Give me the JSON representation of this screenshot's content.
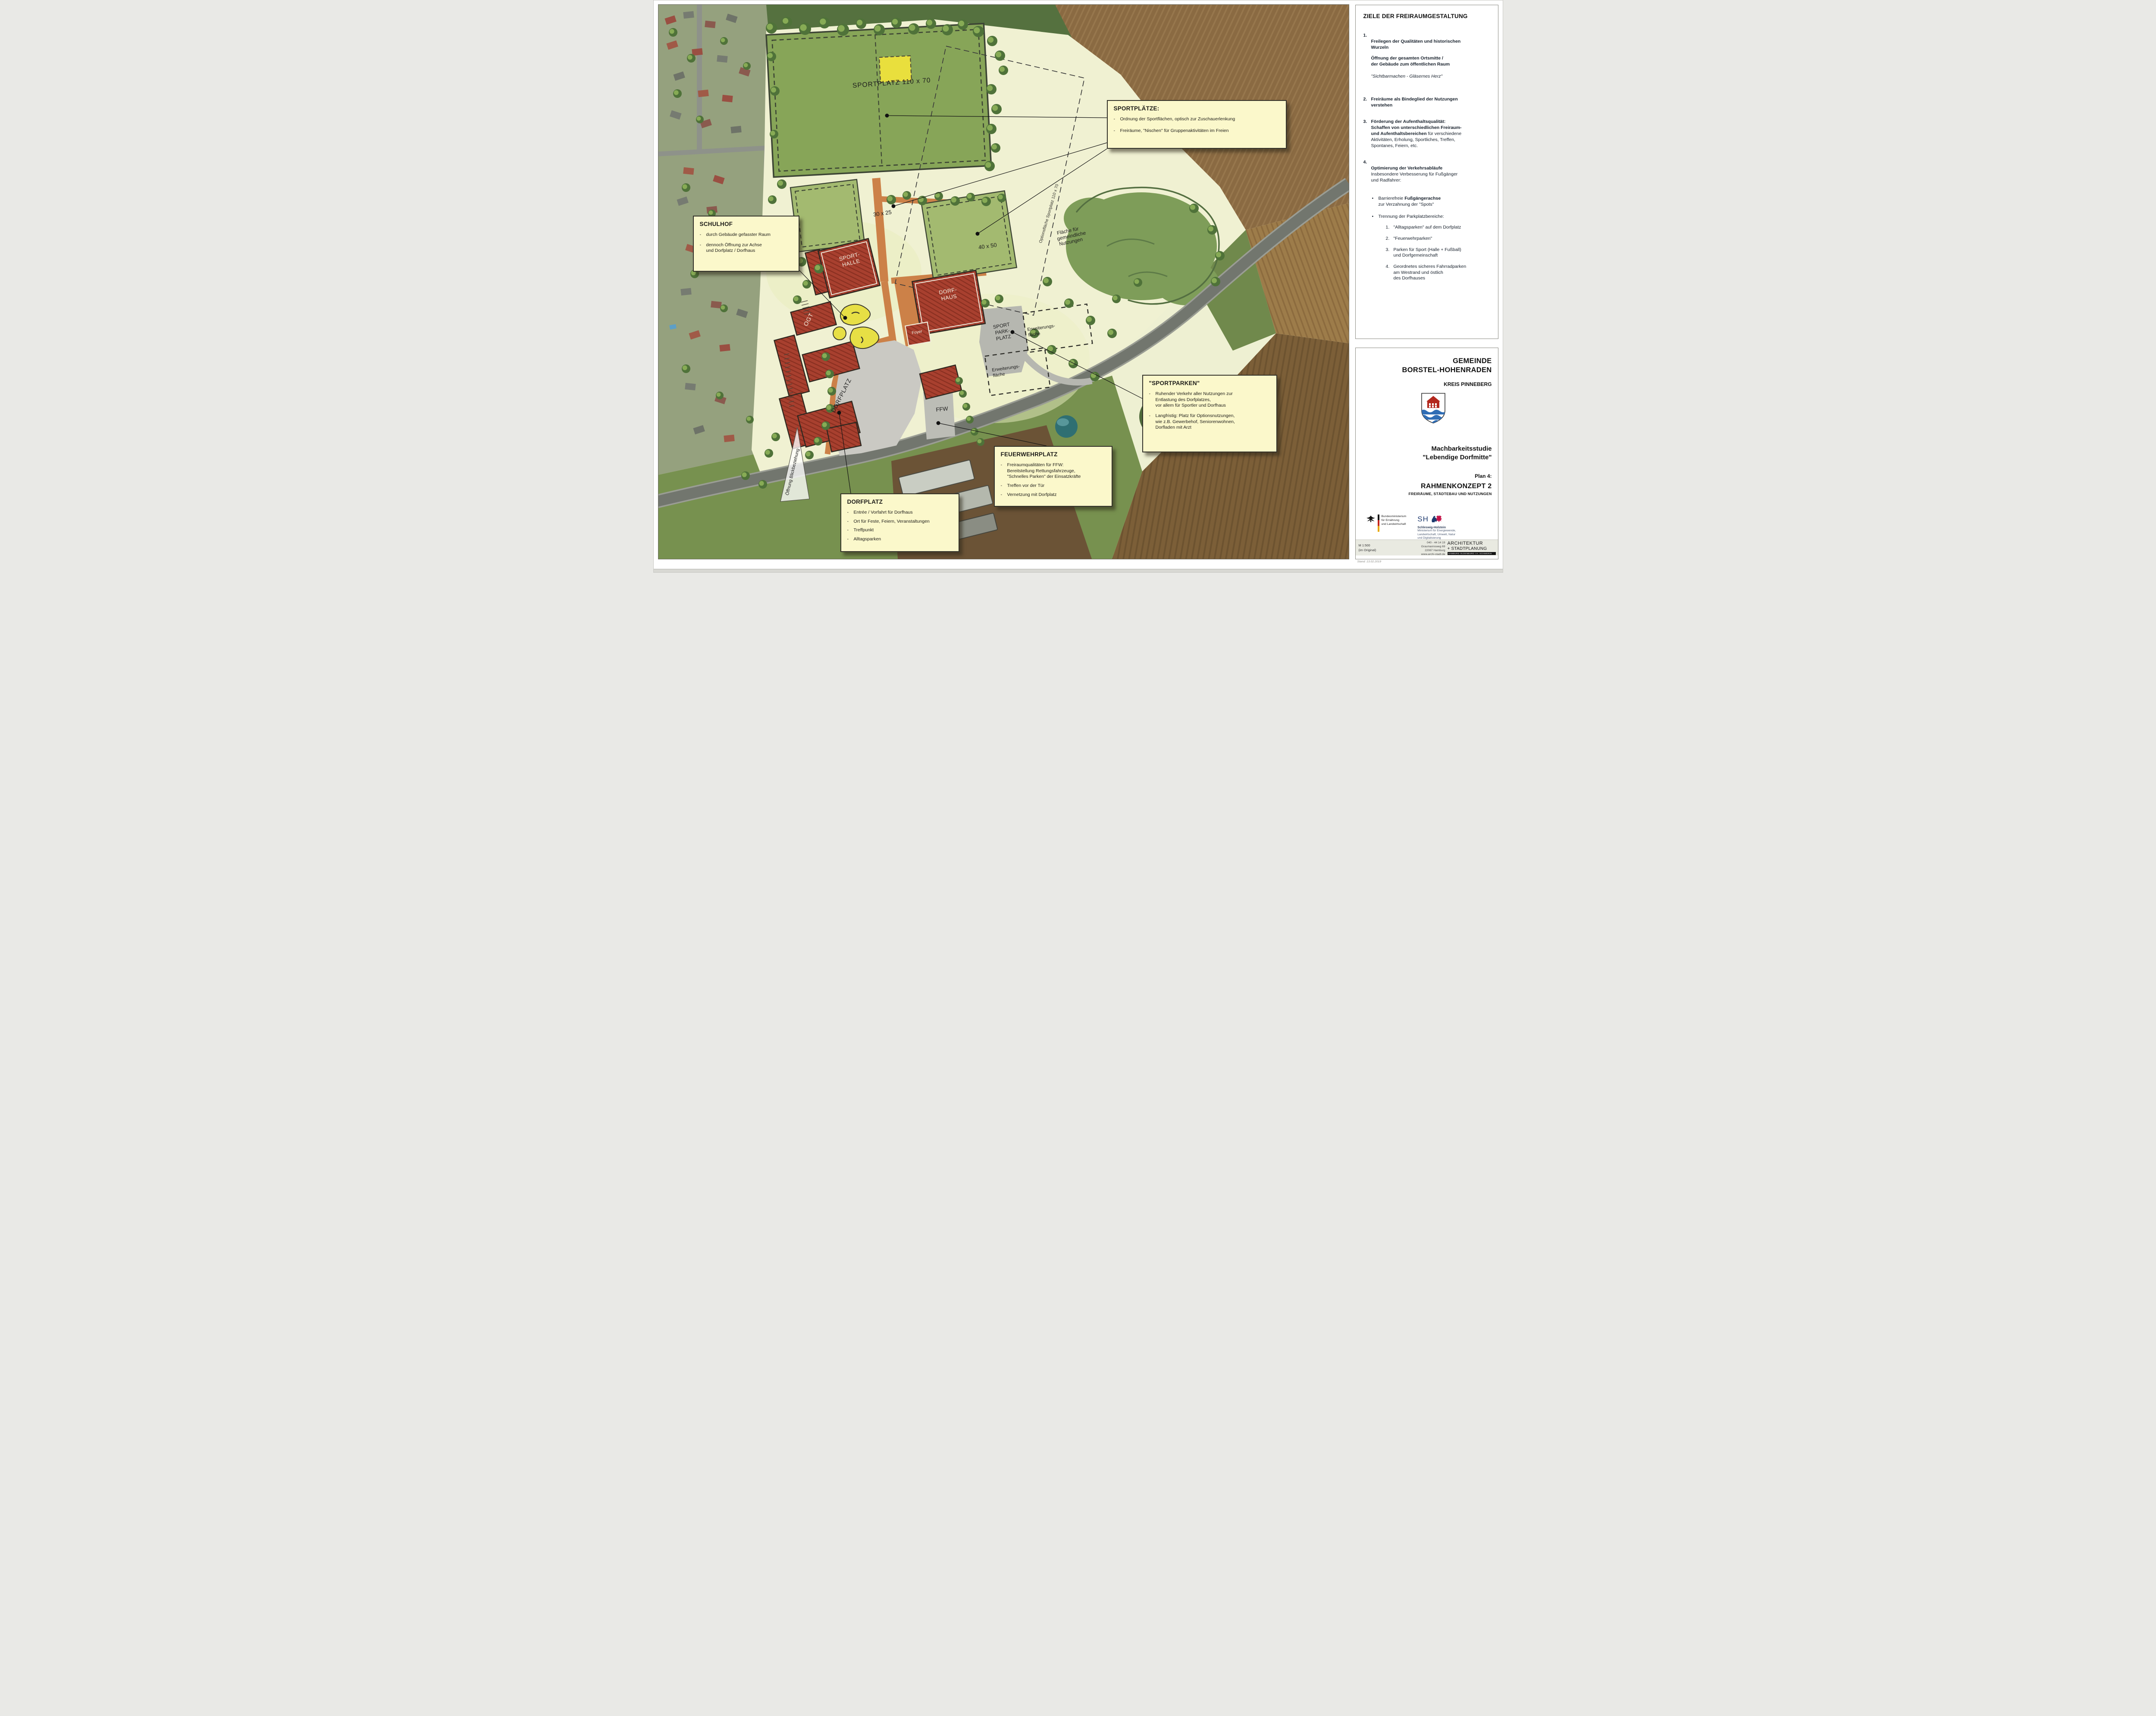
{
  "chars": {
    "dash": "-",
    "bullet": "•"
  },
  "map": {
    "labels": {
      "sportplatz": "SPORTPLATZ 110 x 70",
      "f30": "30 x 25",
      "f40": "40 x 50",
      "sh1": "SPORT-",
      "sh2": "HALLE",
      "dh1": "DORF-",
      "dh2": "HAUS",
      "foyer": "Foyer",
      "ogt": "OGT",
      "ffw": "FFW",
      "dorfplatz": "DORFPLATZ",
      "spp1": "SPORT",
      "spp2": "PARK-",
      "spp3": "PLATZ",
      "erw1": "Erweiterungs-",
      "erw2": "fläche",
      "gf1": "Fläche für",
      "gf2": "gemeindliche",
      "gf3": "Nutzungen",
      "options": "Optionsfläche Sportplatz 110 x 70",
      "blick": "Öffnung Blickbeziehung"
    },
    "notes": {
      "sportplaetze": {
        "title": "SPORTPLÄTZE:",
        "item1": "Ordnung der Sportflächen, optisch zur Zuschauerlenkung",
        "item2": "Freiräume, \"Nischen\" für Gruppenaktivitäten im Freien"
      },
      "schulhof": {
        "title": "SCHULHOF",
        "item1": "durch Gebäude gefasster Raum",
        "item2": "dennoch Öffnung zur Achse\nund Dorfplatz / Dorfhaus"
      },
      "sportparken": {
        "title": "\"SPORTPARKEN\"",
        "item1": "Ruhender Verkehr aller Nutzungen zur\nEntlastung des Dorfplatzes,\nvor allem für Sportler und Dorfhaus",
        "item2": "Langfristig: Platz für Optionsnutzungen,\nwie z.B. Gewerbehof, Seniorenwohnen,\nDorfladen mit Arzt"
      },
      "feuerwehrplatz": {
        "title": "FEUERWEHRPLATZ",
        "item1": "Freiraumqualitäten für FFW:\nBereitstellung Rettungsfahrzeuge,\n\"Schnelles Parken\" der Einsatzkräfte",
        "item2": "Treffen vor der Tür",
        "item3": "Vernetzung mit Dorfplatz"
      },
      "dorfplatz": {
        "title": "DORFPLATZ",
        "item1": "Entrée / Vorfahrt für Dorfhaus",
        "item2": "Ort für Feste, Feiern, Veranstaltungen",
        "item3": "Treffpunkt",
        "item4": "Alltagsparken"
      }
    }
  },
  "goals": {
    "title": "ZIELE DER FREIRAUMGESTALTUNG",
    "i1num": "1.",
    "i1head": "Freilegen der Qualitäten und historischen\nWurzeln",
    "i1para": "Öffnung der gesamten Ortsmitte /\nder Gebäude zum öffentlichen Raum",
    "i1quote": "\"Sichtbarmachen - Gläsernes Herz\"",
    "i2num": "2.",
    "i2head": "Freiräume als Bindeglied der Nutzungen\nverstehen",
    "i3num": "3.",
    "i3head": "Förderung der Aufenthaltsqualität:\nSchaffen von unterschiedlichen Freiraum-\nund Aufenthaltsbereichen",
    "i3rest": " für verschiedene\nAktivitäten, Erholung, Sportliches, Treffen,\nSpontanes, Feiern, etc.",
    "i4num": "4.",
    "i4head": "Optimierung der Verkehrsabläufe",
    "i4sub": "Insbesondere Verbesserung für Fußgänger\nund Radfahrer:",
    "b1a": "Barrierefreie ",
    "b1b": "Fußgängerachse",
    "b1c": "zur Verzahnung der \"Spots\"",
    "b2": "Trennung der Parkplatzbereiche:",
    "p1num": "1.",
    "p1": "\"Alltagsparken\" auf dem Dorfplatz",
    "p2num": "2.",
    "p2": "\"Feuerwehrparken\"",
    "p3num": "3.",
    "p3": "Parken für Sport (Halle + Fußball)\nund Dorfgemeinschaft",
    "p4num": "4.",
    "p4": "Geordnetes sicheres Fahrradparken\nam Westrand und östlich\ndes Dorfhauses"
  },
  "titleblock": {
    "line1": "GEMEINDE",
    "line2": "BORSTEL-HOHENRADEN",
    "kreis": "KREIS PINNEBERG",
    "study1": "Machbarkeitsstudie",
    "study2": "\"Lebendige Dorfmitte\"",
    "plan": "Plan 4:",
    "konzept": "RAHMENKONZEPT 2",
    "konzept_sub": "FREIRÄUME, STÄDTEBAU UND NUTZUNGEN",
    "logo_bund": "Bundesministerium\nfür Ernährung\nund Landwirtschaft",
    "logo_sh": "SH",
    "logo_sh_name": "Schleswig-Holstein",
    "logo_sh_sub": "Ministerium für Energiewende,\nLandwirtschaft, Umwelt, Natur\nund Digitalisierung",
    "scale1": "M 1:500",
    "scale2": "(im Original)",
    "contact": "040 - 44 14 19\nGraumannsweg 69\n22087 Hamburg\nwww.archi-stadt.de",
    "firm1": "ARCHITEKTUR",
    "firm2": "+ STADTPLANUNG",
    "firm_cities": "HAMBURG   OLDENBURG I.H.   SCHWERIN",
    "stand": "Stand: 13.02.2019"
  }
}
